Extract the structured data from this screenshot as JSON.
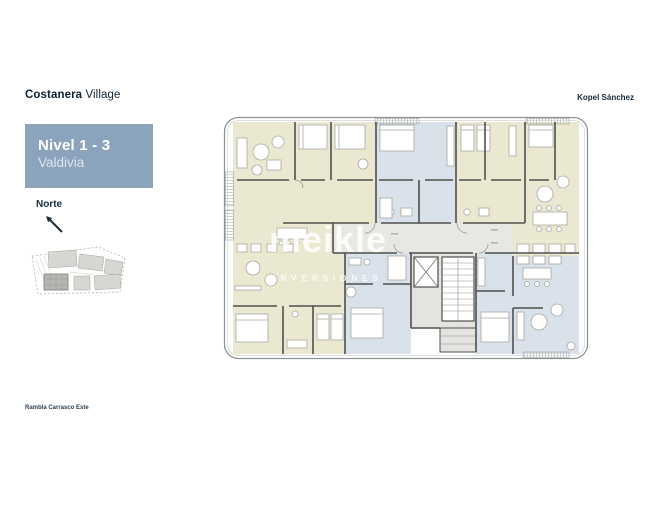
{
  "header": {
    "brand": {
      "bold": "Costanera",
      "light": " Village"
    },
    "firm": "Kopel Sánchez"
  },
  "level_box": {
    "title": "Nivel 1 - 3",
    "subtitle": "Valdivia",
    "background": "#8ba3bd"
  },
  "north": {
    "label": "Norte"
  },
  "watermark": {
    "line1": "meikle",
    "line2": "INVERSIONES"
  },
  "street_label": "Rambla Carrasco Este",
  "floor_plan": {
    "unit_colors": {
      "cream": "#ebe8d2",
      "blue": "#d9e1ea",
      "core_gray": "#e6e6e2"
    },
    "wall_color": "#4f4f4d",
    "outline_color": "#8e9494"
  }
}
